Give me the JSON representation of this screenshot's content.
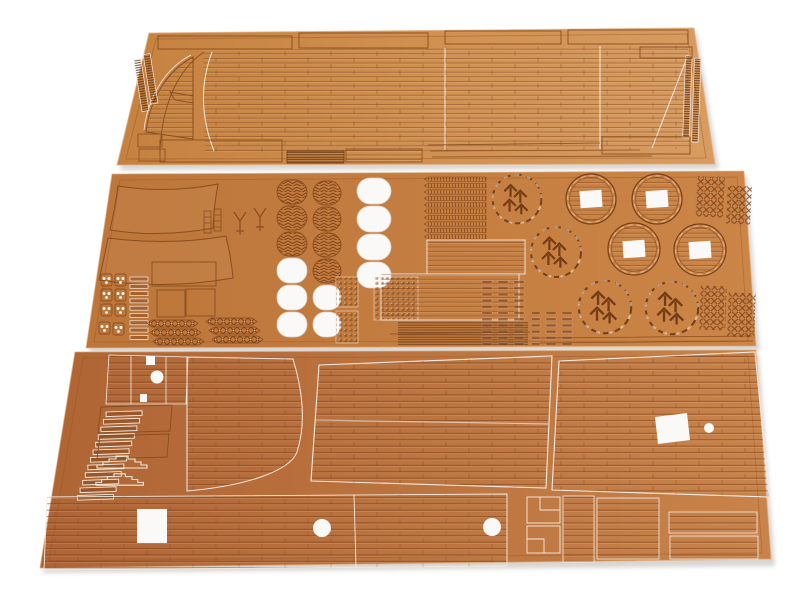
{
  "meta": {
    "title": "Laser-cut wooden model ship deck sheets",
    "subject": "Product photo: three laser-cut wooden sheets with ship deck planking and fitting parts on a white background",
    "sheet_count": "3"
  },
  "palette": {
    "bg": "#ffffff",
    "wood1a": "#c5813f",
    "wood1b": "#d09050",
    "wood1c": "#d89c61",
    "wood2a": "#bd763a",
    "wood2b": "#cb8546",
    "wood3a": "#af6434",
    "wood3b": "#c8834a",
    "engrave": "#8a4e1f",
    "engravedark": "#6f3d17",
    "cut": "#f3ebe1",
    "hole": "#fbf9f7",
    "darkstrip": "#7c451d",
    "shadow": "#9a938b"
  },
  "sheets": [
    {
      "id": "top",
      "name": "Main deck planking sheet",
      "parts": "bow deck piece with curved planking, long deck plank fields, toothed ladder racks on both ends, plank strips"
    },
    {
      "id": "middle",
      "name": "Fittings and gratings sheet",
      "parts": "curved bulkhead pieces, blocks with holes, hatch gratings, rope strips, planked hatches, round gratings",
      "herringbone_oval_gratings": "7",
      "white_oval_cutouts": "9",
      "ring_parts_with_square_hole": "4",
      "ornamental_round_gratings": "4",
      "lattice_grating_pieces": "4"
    },
    {
      "id": "bottom",
      "name": "Deck sections sheet",
      "parts": "large deck panels with butt-jointed planking, stair parts, ladder rungs, cutouts",
      "white_cutouts": "2 squares, 1 rectangle, 4 circles"
    }
  ]
}
